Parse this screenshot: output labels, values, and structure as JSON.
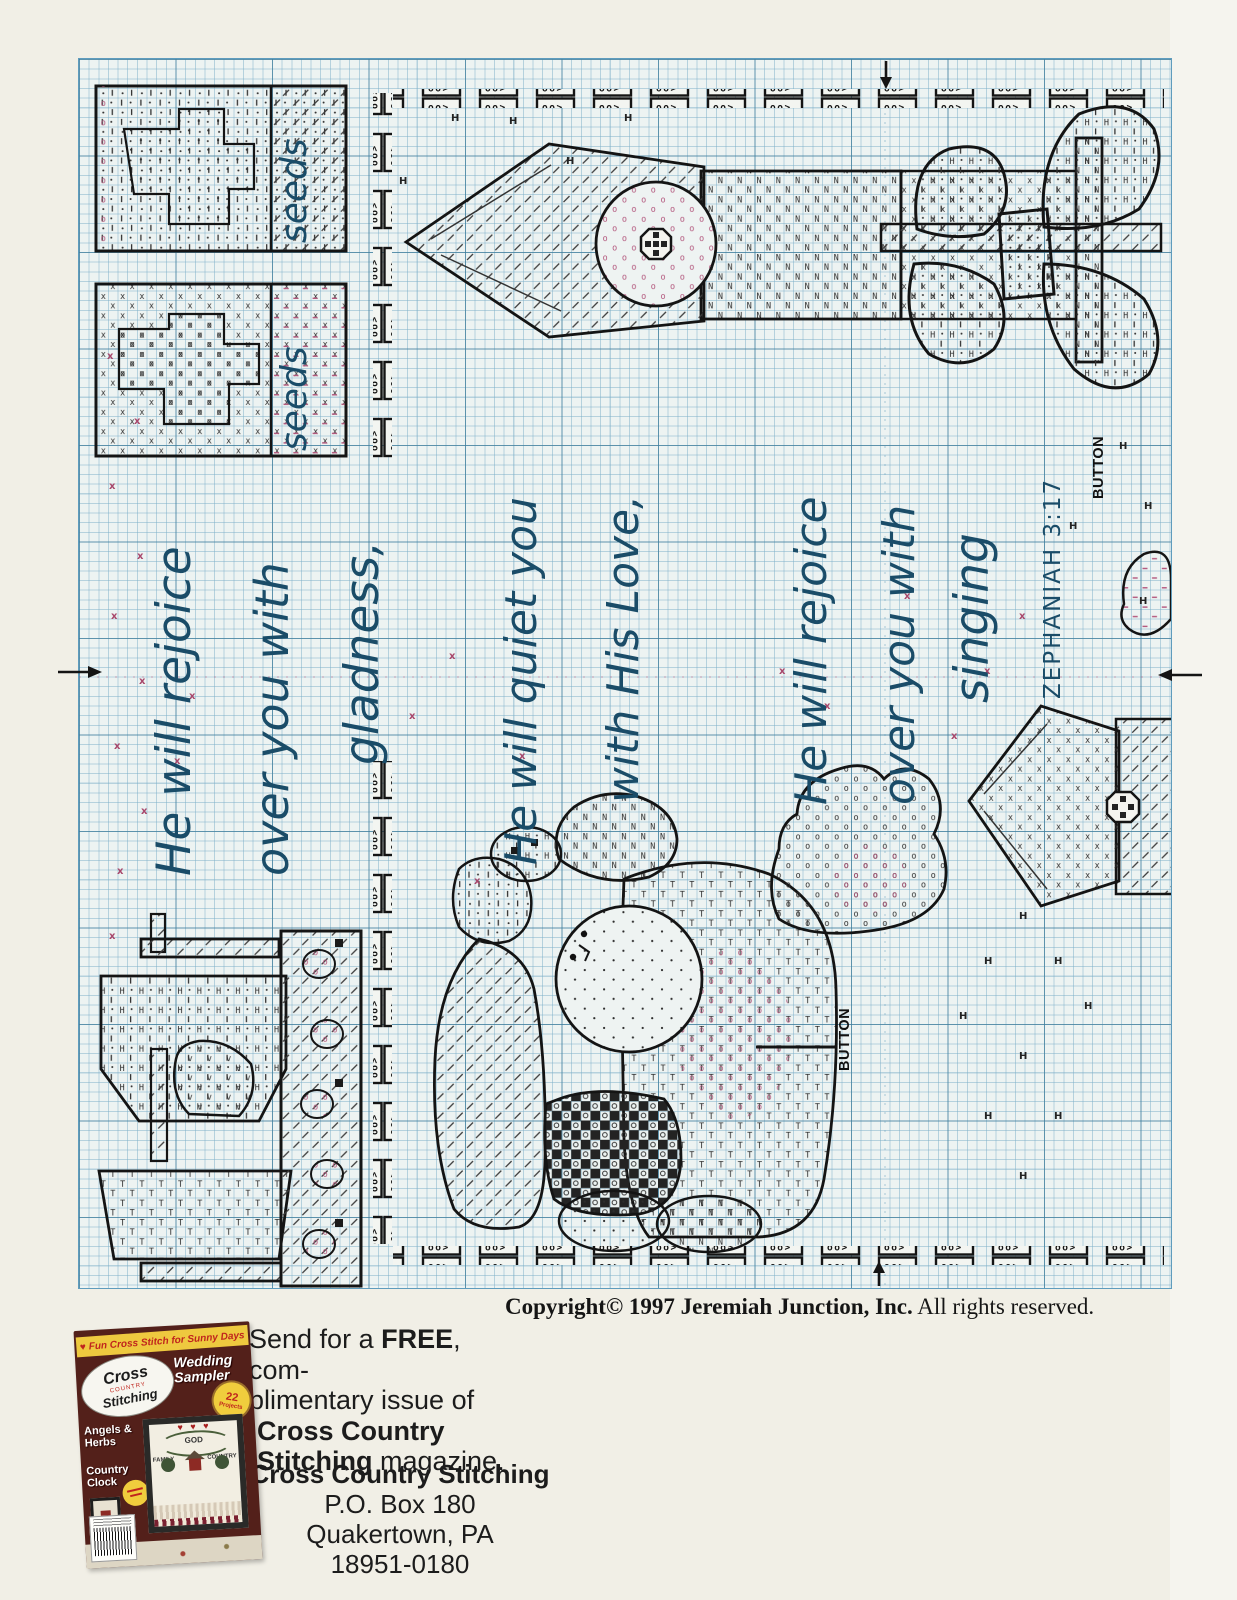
{
  "chart": {
    "handwritten_note": "laurie 11.29.04",
    "verse_left_1": "He will rejoice",
    "verse_left_2": "over you with",
    "verse_left_3": "gladness,",
    "verse_mid_1": "He will quiet you",
    "verse_mid_2": "with His Love,",
    "verse_right_1": "He will rejoice",
    "verse_right_2": "over you with",
    "verse_right_3": "singing",
    "verse_reference": "ZEPHANIAH 3:17",
    "label_button_top": "BUTTON",
    "label_button_center": "BUTTON",
    "label_seeds_top": "seeds",
    "label_seeds_bottom": "seeds"
  },
  "footer": {
    "copyright_main": "Copyright© 1997 Jeremiah Junction, Inc.",
    "copyright_suffix": " All rights reserved."
  },
  "ad": {
    "offer_pre": "Send for a ",
    "offer_bold": "FREE",
    "offer_post": ", com-",
    "offer_line2": "plimentary issue of",
    "offer_line3": "Cross Country",
    "offer_line4_bold": "Stitching",
    "offer_line4_rest": " magazine.",
    "addr_name": "Cross Country Stitching",
    "addr_box": "P.O. Box 180",
    "addr_city": "Quakertown, PA",
    "addr_zip": "18951-0180"
  },
  "magazine": {
    "banner": "Fun Cross Stitch for Sunny Days",
    "logo_top": "Cross",
    "logo_mid": "COUNTRY",
    "logo_bottom": "Stitching",
    "feature_line1": "Wedding",
    "feature_line2": "Sampler",
    "burst_number": "22",
    "burst_word": "Projects",
    "side_feature1_line1": "Angels &",
    "side_feature1_line2": "Herbs",
    "side_feature2_line1": "Country",
    "side_feature2_line2": "Clock",
    "sampler_word1": "GOD",
    "sampler_word2": "FAMILY",
    "sampler_word3": "COUNTRY"
  },
  "colors": {
    "grid_minor": "#aed2e0",
    "grid_major": "#5f9cbd",
    "backstitch_blue": "#1a4c68",
    "symbol_red": "#a8476b",
    "ink": "#1a1a1a",
    "page_bg": "#f1efe6"
  }
}
